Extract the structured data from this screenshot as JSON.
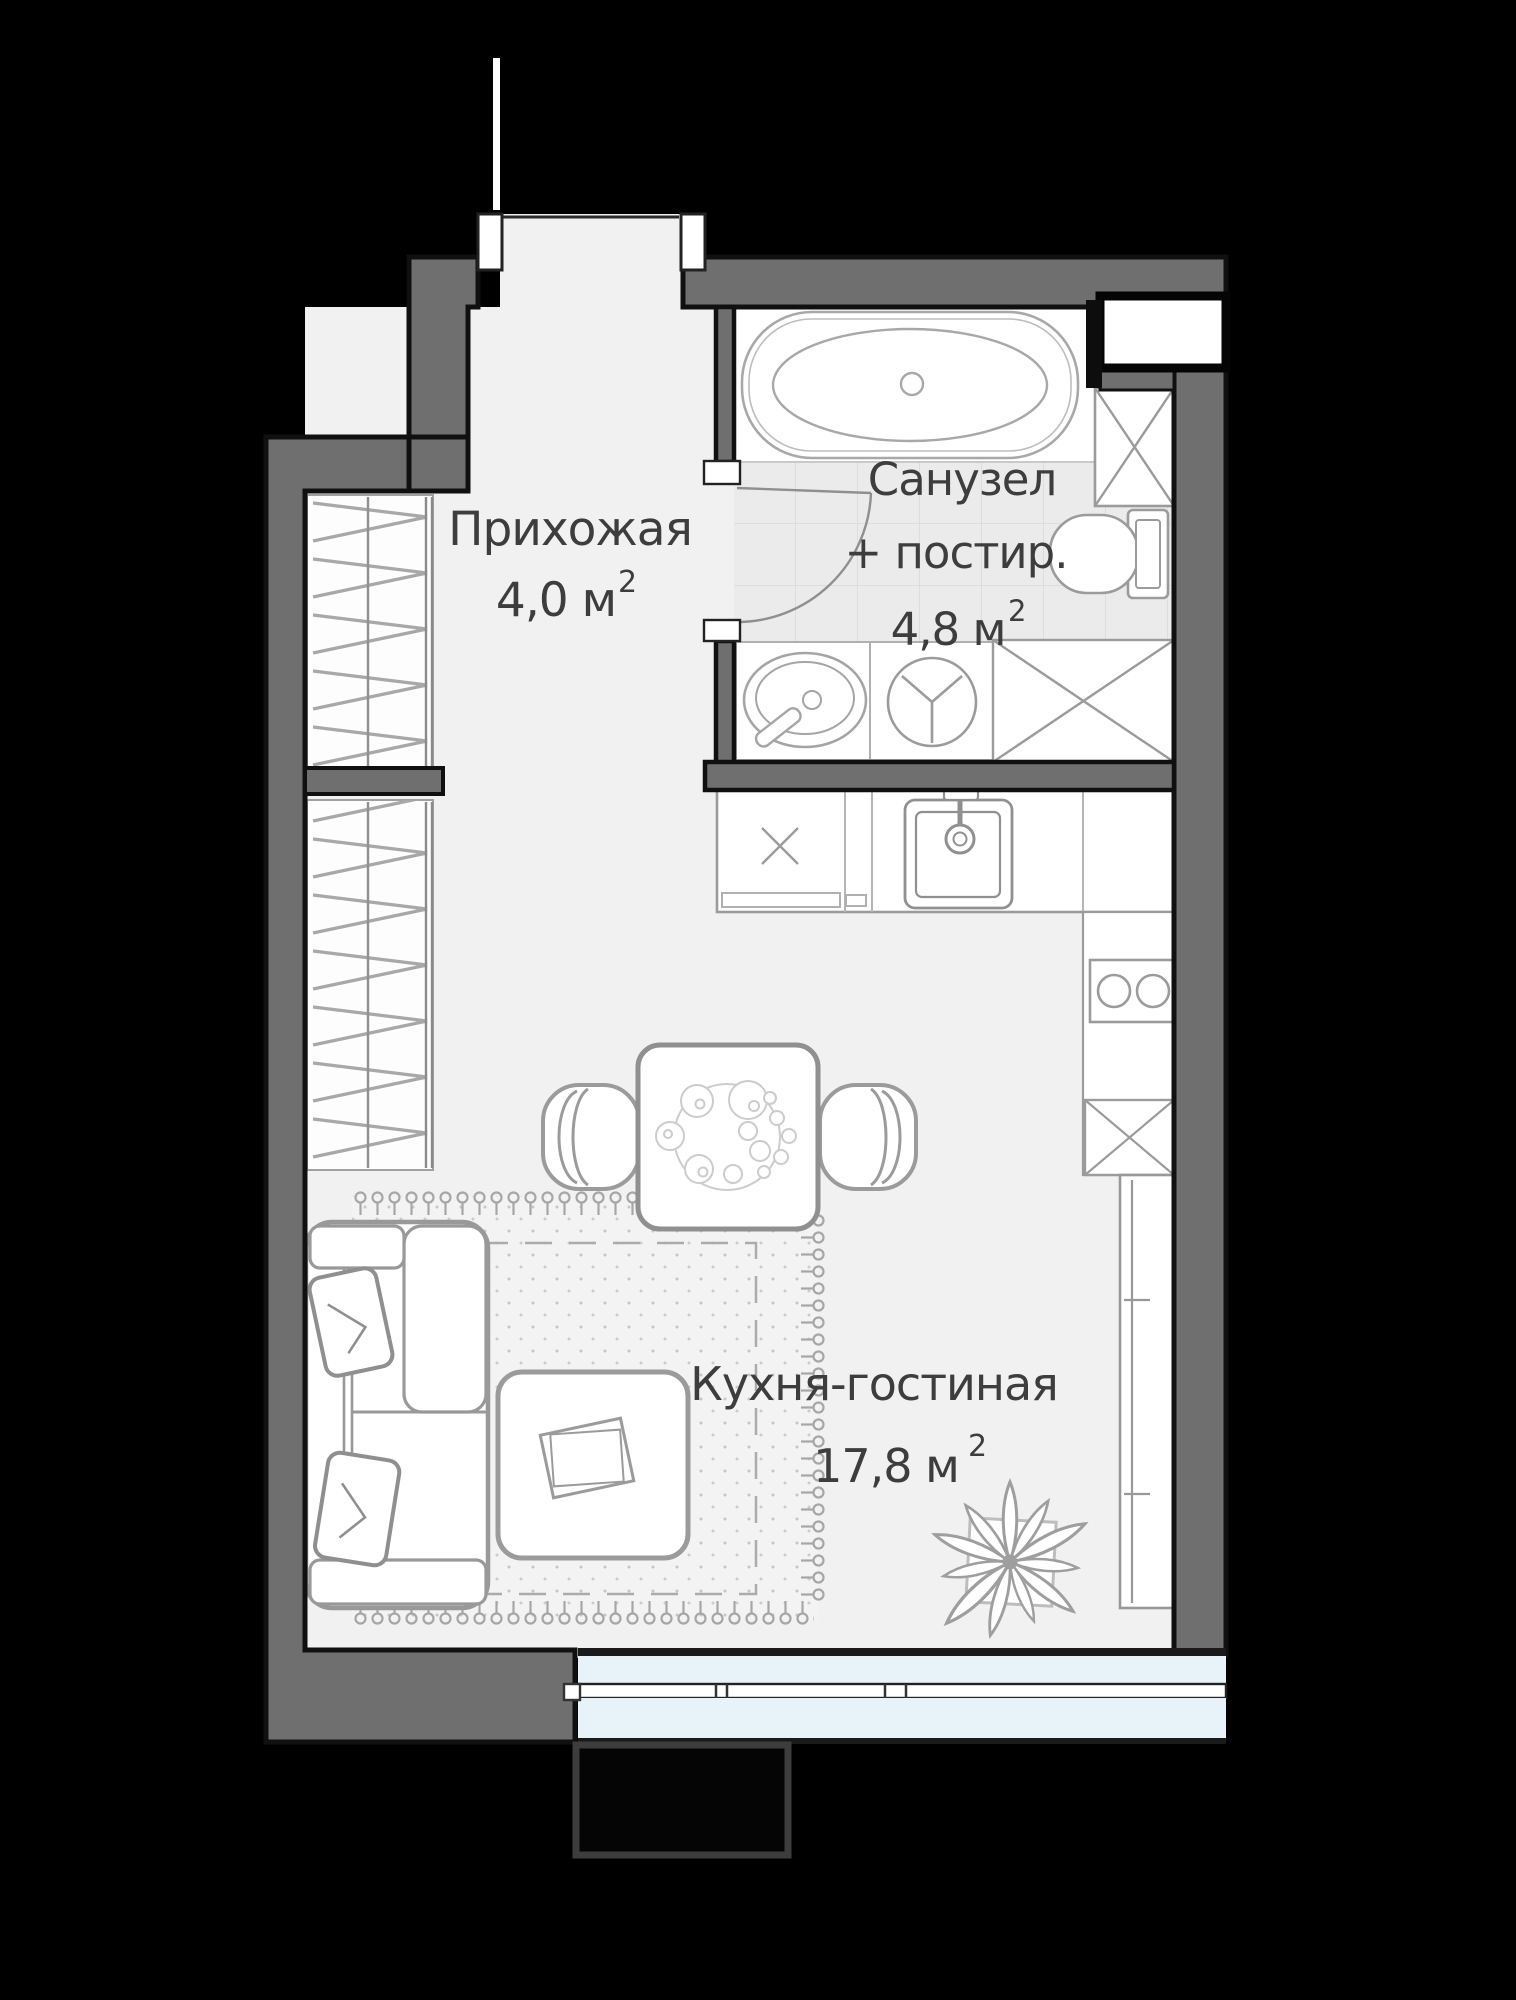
{
  "colors": {
    "background": "#000000",
    "wall": "#6f6f6f",
    "wall_outline": "#101010",
    "floor": "#f1f1f1",
    "tile": "#ebebeb",
    "fixture_fill": "#ffffff",
    "fixture_stroke": "#9b9b9b",
    "glass": "#e7f3f8",
    "text": "#3d3d3d"
  },
  "rooms": {
    "hallway": {
      "label": "Прихожая",
      "area": "4,0 м",
      "area_sup": "2"
    },
    "bathroom": {
      "label_line1": "Санузел",
      "label_line2": "+ постир.",
      "area": "4,8 м",
      "area_sup": "2"
    },
    "kitchen_living": {
      "label": "Кухня-гостиная",
      "area": "17,8 м",
      "area_sup": "2"
    }
  },
  "icons": [
    "bathtub-icon",
    "toilet-icon",
    "washing-machine-icon",
    "bathroom-sink-icon",
    "duct-icon",
    "kitchen-sink-icon",
    "stove-icon",
    "fridge-icon",
    "dining-table-icon",
    "plate-icon",
    "chair-icon",
    "sofa-icon",
    "pillow-icon",
    "coffee-table-icon",
    "plant-icon",
    "wardrobe-icon",
    "rug-icon",
    "zone-dashed-icon",
    "window-icon",
    "balcony-icon",
    "entrance-door-icon",
    "bathroom-door-icon"
  ]
}
